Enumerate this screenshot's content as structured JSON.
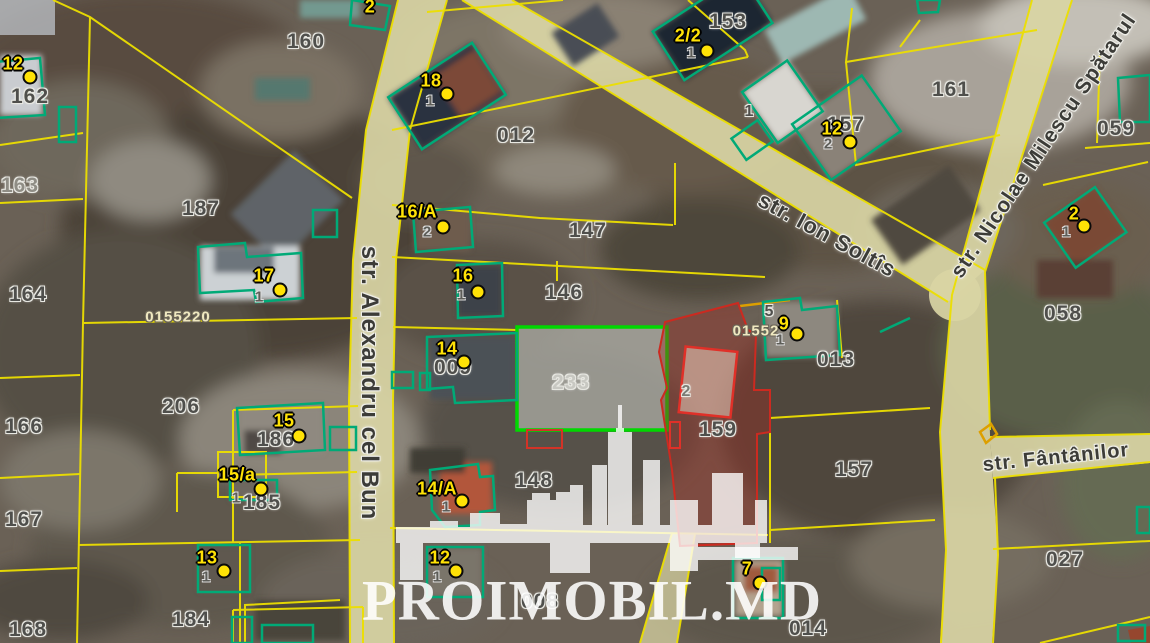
{
  "map_type": "cadastral-satellite-map",
  "streets": [
    {
      "name": "str. Alexandru cel Bun"
    },
    {
      "name": "str. Ion Soltîs"
    },
    {
      "name": "str. Nicolae Milescu Spătarul"
    },
    {
      "name": "str. Fântânilor"
    }
  ],
  "labels": {
    "parcels": [
      "162",
      "163",
      "164",
      "166",
      "167",
      "168",
      "160",
      "187",
      "206",
      "184",
      "185",
      "186",
      "012",
      "147",
      "146",
      "233",
      "009",
      "148",
      "159",
      "157",
      "153",
      "157",
      "161",
      "059",
      "058",
      "013",
      "027",
      "014",
      "008",
      "5",
      "2",
      "1"
    ]
  },
  "codes": [
    "0155220",
    "01552"
  ],
  "markers": [
    {
      "n": "12",
      "s": ""
    },
    {
      "n": "18",
      "s": "1"
    },
    {
      "n": "16/A",
      "s": "2"
    },
    {
      "n": "16",
      "s": "1"
    },
    {
      "n": "17",
      "s": "1"
    },
    {
      "n": "14",
      "s": ""
    },
    {
      "n": "15",
      "s": ""
    },
    {
      "n": "15/a",
      "s": "1"
    },
    {
      "n": "14/A",
      "s": "1"
    },
    {
      "n": "13",
      "s": "1"
    },
    {
      "n": "12",
      "s": "1"
    },
    {
      "n": "2/2",
      "s": "1"
    },
    {
      "n": "12",
      "s": "2"
    },
    {
      "n": "2",
      "s": "1"
    },
    {
      "n": "9",
      "s": "1"
    },
    {
      "n": "7",
      "s": ""
    },
    {
      "n": "2",
      "s": ""
    }
  ],
  "watermark": {
    "text": "PROIMOBIL.MD"
  },
  "colors": {
    "parcel_line": "#ecdf00",
    "building_outline": "#00aa77",
    "selected_parcel_outline": "#00d800",
    "highlight_red": "#cc2a20",
    "marker_yellow": "#ffe206",
    "road_fill": "#d9d5a4"
  }
}
